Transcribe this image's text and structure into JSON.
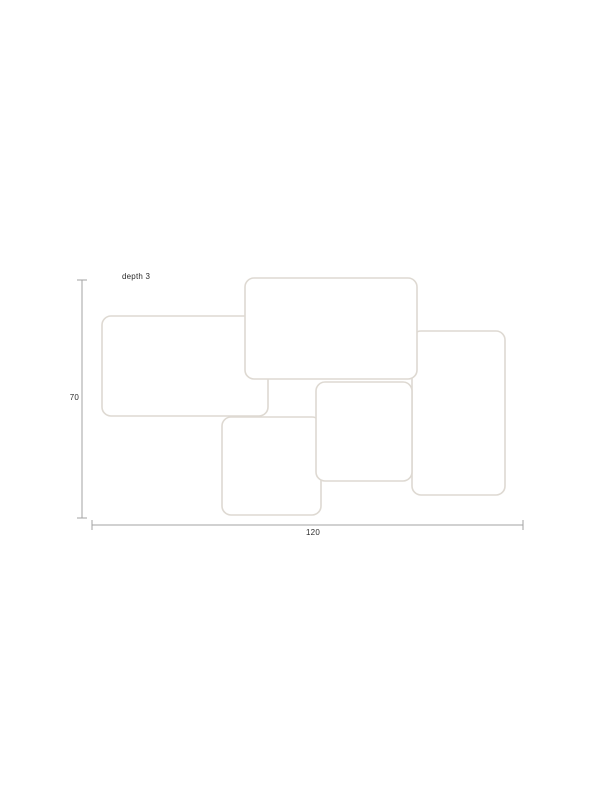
{
  "page": {
    "width": 612,
    "height": 792,
    "background": "#ffffff"
  },
  "diagram": {
    "type": "dimension-drawing",
    "subject": "set of five overlapping rounded-rectangle wall frames, front view",
    "frame_fill": "#ffffff",
    "frame_stroke": "#ded9d2",
    "frame_stroke_width": 1.6,
    "corner_radius": 9,
    "frames": [
      {
        "name": "right-frame",
        "x": 412,
        "y": 331,
        "w": 93,
        "h": 164
      },
      {
        "name": "left-frame",
        "x": 102,
        "y": 316,
        "w": 166,
        "h": 100
      },
      {
        "name": "bottom-frame",
        "x": 222,
        "y": 417,
        "w": 99,
        "h": 98
      },
      {
        "name": "top-frame",
        "x": 245,
        "y": 278,
        "w": 172,
        "h": 101
      },
      {
        "name": "center-frame",
        "x": 316,
        "y": 382,
        "w": 96,
        "h": 99
      }
    ],
    "dimensions": {
      "line_color": "#a3a3a3",
      "line_width": 1,
      "tick_half_length": 5,
      "text_color": "#2b2b2b",
      "height": {
        "label": "70",
        "line": {
          "x": 82,
          "y1": 280,
          "y2": 518
        },
        "label_pos": {
          "x": 79,
          "y": 398
        }
      },
      "width": {
        "label": "120",
        "line": {
          "y": 525,
          "x1": 92,
          "x2": 523
        },
        "label_pos": {
          "x": 313,
          "y": 533
        }
      },
      "depth_note": {
        "text": "depth 3",
        "pos": {
          "x": 122,
          "y": 277
        }
      }
    }
  }
}
